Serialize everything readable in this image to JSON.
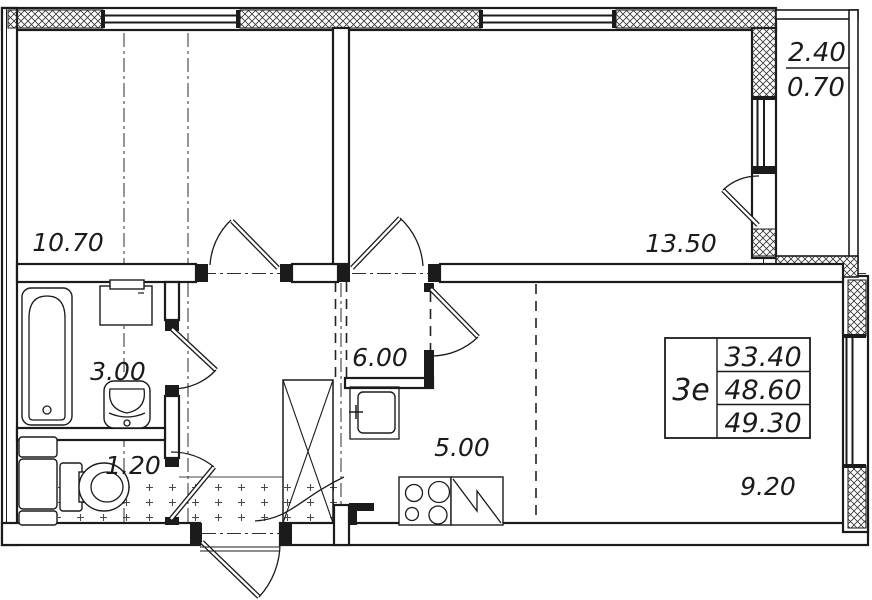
{
  "floor_plan": {
    "room_areas": {
      "top_left_room": "10.70",
      "top_right_room": "13.50",
      "bathroom": "3.00",
      "wc": "1.20",
      "hallway": "6.00",
      "kitchen": "5.00",
      "living_room": "9.20"
    },
    "balcony": {
      "area_total": "2.40",
      "area_reduced": "0.70"
    },
    "stamp": {
      "unit_label": "3е",
      "values": [
        "33.40",
        "48.60",
        "49.30"
      ]
    },
    "fixtures": [
      "bathtub",
      "washing-machine",
      "bathroom-sink",
      "toilet",
      "water-heater-cabinet",
      "wardrobe",
      "kitchen-sink",
      "stove",
      "kitchen-counter",
      "entrance-door",
      "balcony-door"
    ],
    "style": {
      "line_color": "#1b1b1b",
      "axis_color": "#2e2e2e",
      "background": "#ffffff"
    }
  }
}
